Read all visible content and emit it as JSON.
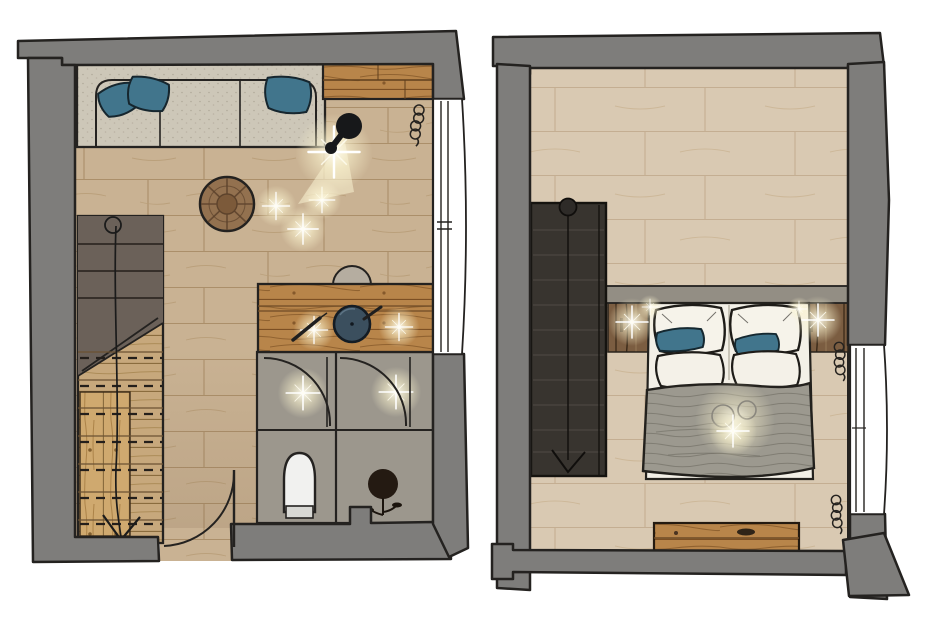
{
  "canvas": {
    "width": 937,
    "height": 626
  },
  "sheet": {
    "kind": "hand-drawn interior floor plan sketch, top view, two panels",
    "views": [
      "living area with bathroom",
      "bedroom"
    ]
  },
  "colors": {
    "wall": "#7e7d7b",
    "outline": "#242220",
    "floor_left": "#c9b293",
    "floor_left_line": "#ab8f6a",
    "floor_right": "#d9c9b2",
    "floor_right_line": "#c4ae92",
    "furniture_wood": "#b8854a",
    "furniture_wood_line": "#7c4f23",
    "pale_wood": "#c7a87c",
    "sofa_fabric": "#cdc7b8",
    "pillow_accent": "#41758c",
    "concrete": "#9c978d",
    "stairs_upper_dark": "#6b6159",
    "stairs_right_dark": "#38342f",
    "bed_linen": "#f3f0e7",
    "blanket": "#9c998f",
    "headboard_band": "#938e84",
    "rustic_wood": "#7b5d41",
    "lamp_black": "#17181a",
    "toilet_white": "#f1f1ef",
    "window_white": "#ffffff",
    "glow": "#fdf7d8"
  },
  "left_plan": {
    "description": "living area with bathroom",
    "objects": [
      "sofa",
      "sofa-pillows",
      "sideboard",
      "floor-lamp",
      "radiator-coil",
      "window",
      "round-coffee-table",
      "staircase",
      "stair-start-marker",
      "stair-direction-arrow",
      "desk",
      "desk-chair",
      "decor-bowl",
      "pens",
      "bathroom",
      "bathroom-door-arcs",
      "toilet",
      "potted-plant",
      "entrance-door",
      "ceiling-light-sparkles"
    ]
  },
  "right_plan": {
    "description": "bedroom",
    "objects": [
      "staircase",
      "stair-start-marker",
      "stair-direction-arrow",
      "double-bed",
      "pillows",
      "accent-pillows",
      "blanket",
      "headboard-band",
      "rustic-headboard-panel",
      "wall-light-sparkles",
      "decor-circles",
      "bench",
      "radiator-coils",
      "window"
    ]
  }
}
